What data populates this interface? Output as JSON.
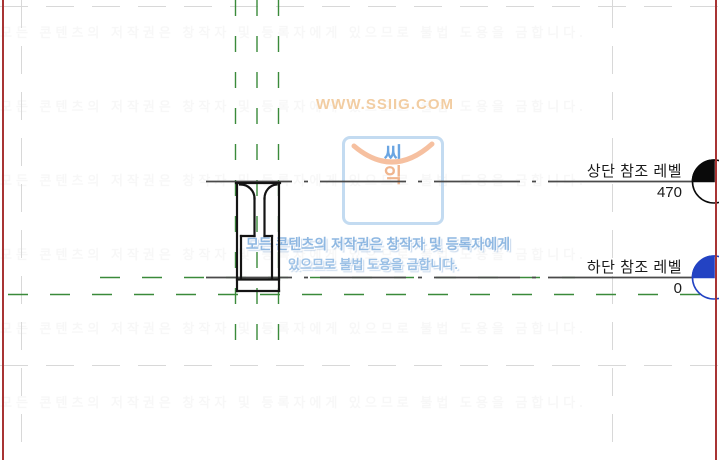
{
  "levels": {
    "upper": {
      "label": "상단 참조 레벨",
      "value": "470"
    },
    "lower": {
      "label": "하단 참조 레벨",
      "value": "0"
    }
  },
  "watermark": {
    "site": "WWW.SSIIG.COM",
    "logo_line1": "씨",
    "logo_line2": "익",
    "copyright_line1": "모든 콘텐츠의 저작권은 창작자 및 등록자에게",
    "copyright_line2": "있으므로 불법 도용을 금합니다.",
    "faint_row_text": "모든 콘텐츠의 저작권은 창작자 및 등록자에게 있으므로 불법 도용을 금합니다."
  },
  "colors": {
    "reference_plane_green": "#3a8a3a",
    "crop_guide_gray": "#d8d8d8",
    "level_line_gray": "#4a4a4a",
    "profile_black": "#141414",
    "border_red": "#a83434",
    "level_head_upper": "#0a0a0a",
    "level_head_lower": "#2343c3"
  }
}
